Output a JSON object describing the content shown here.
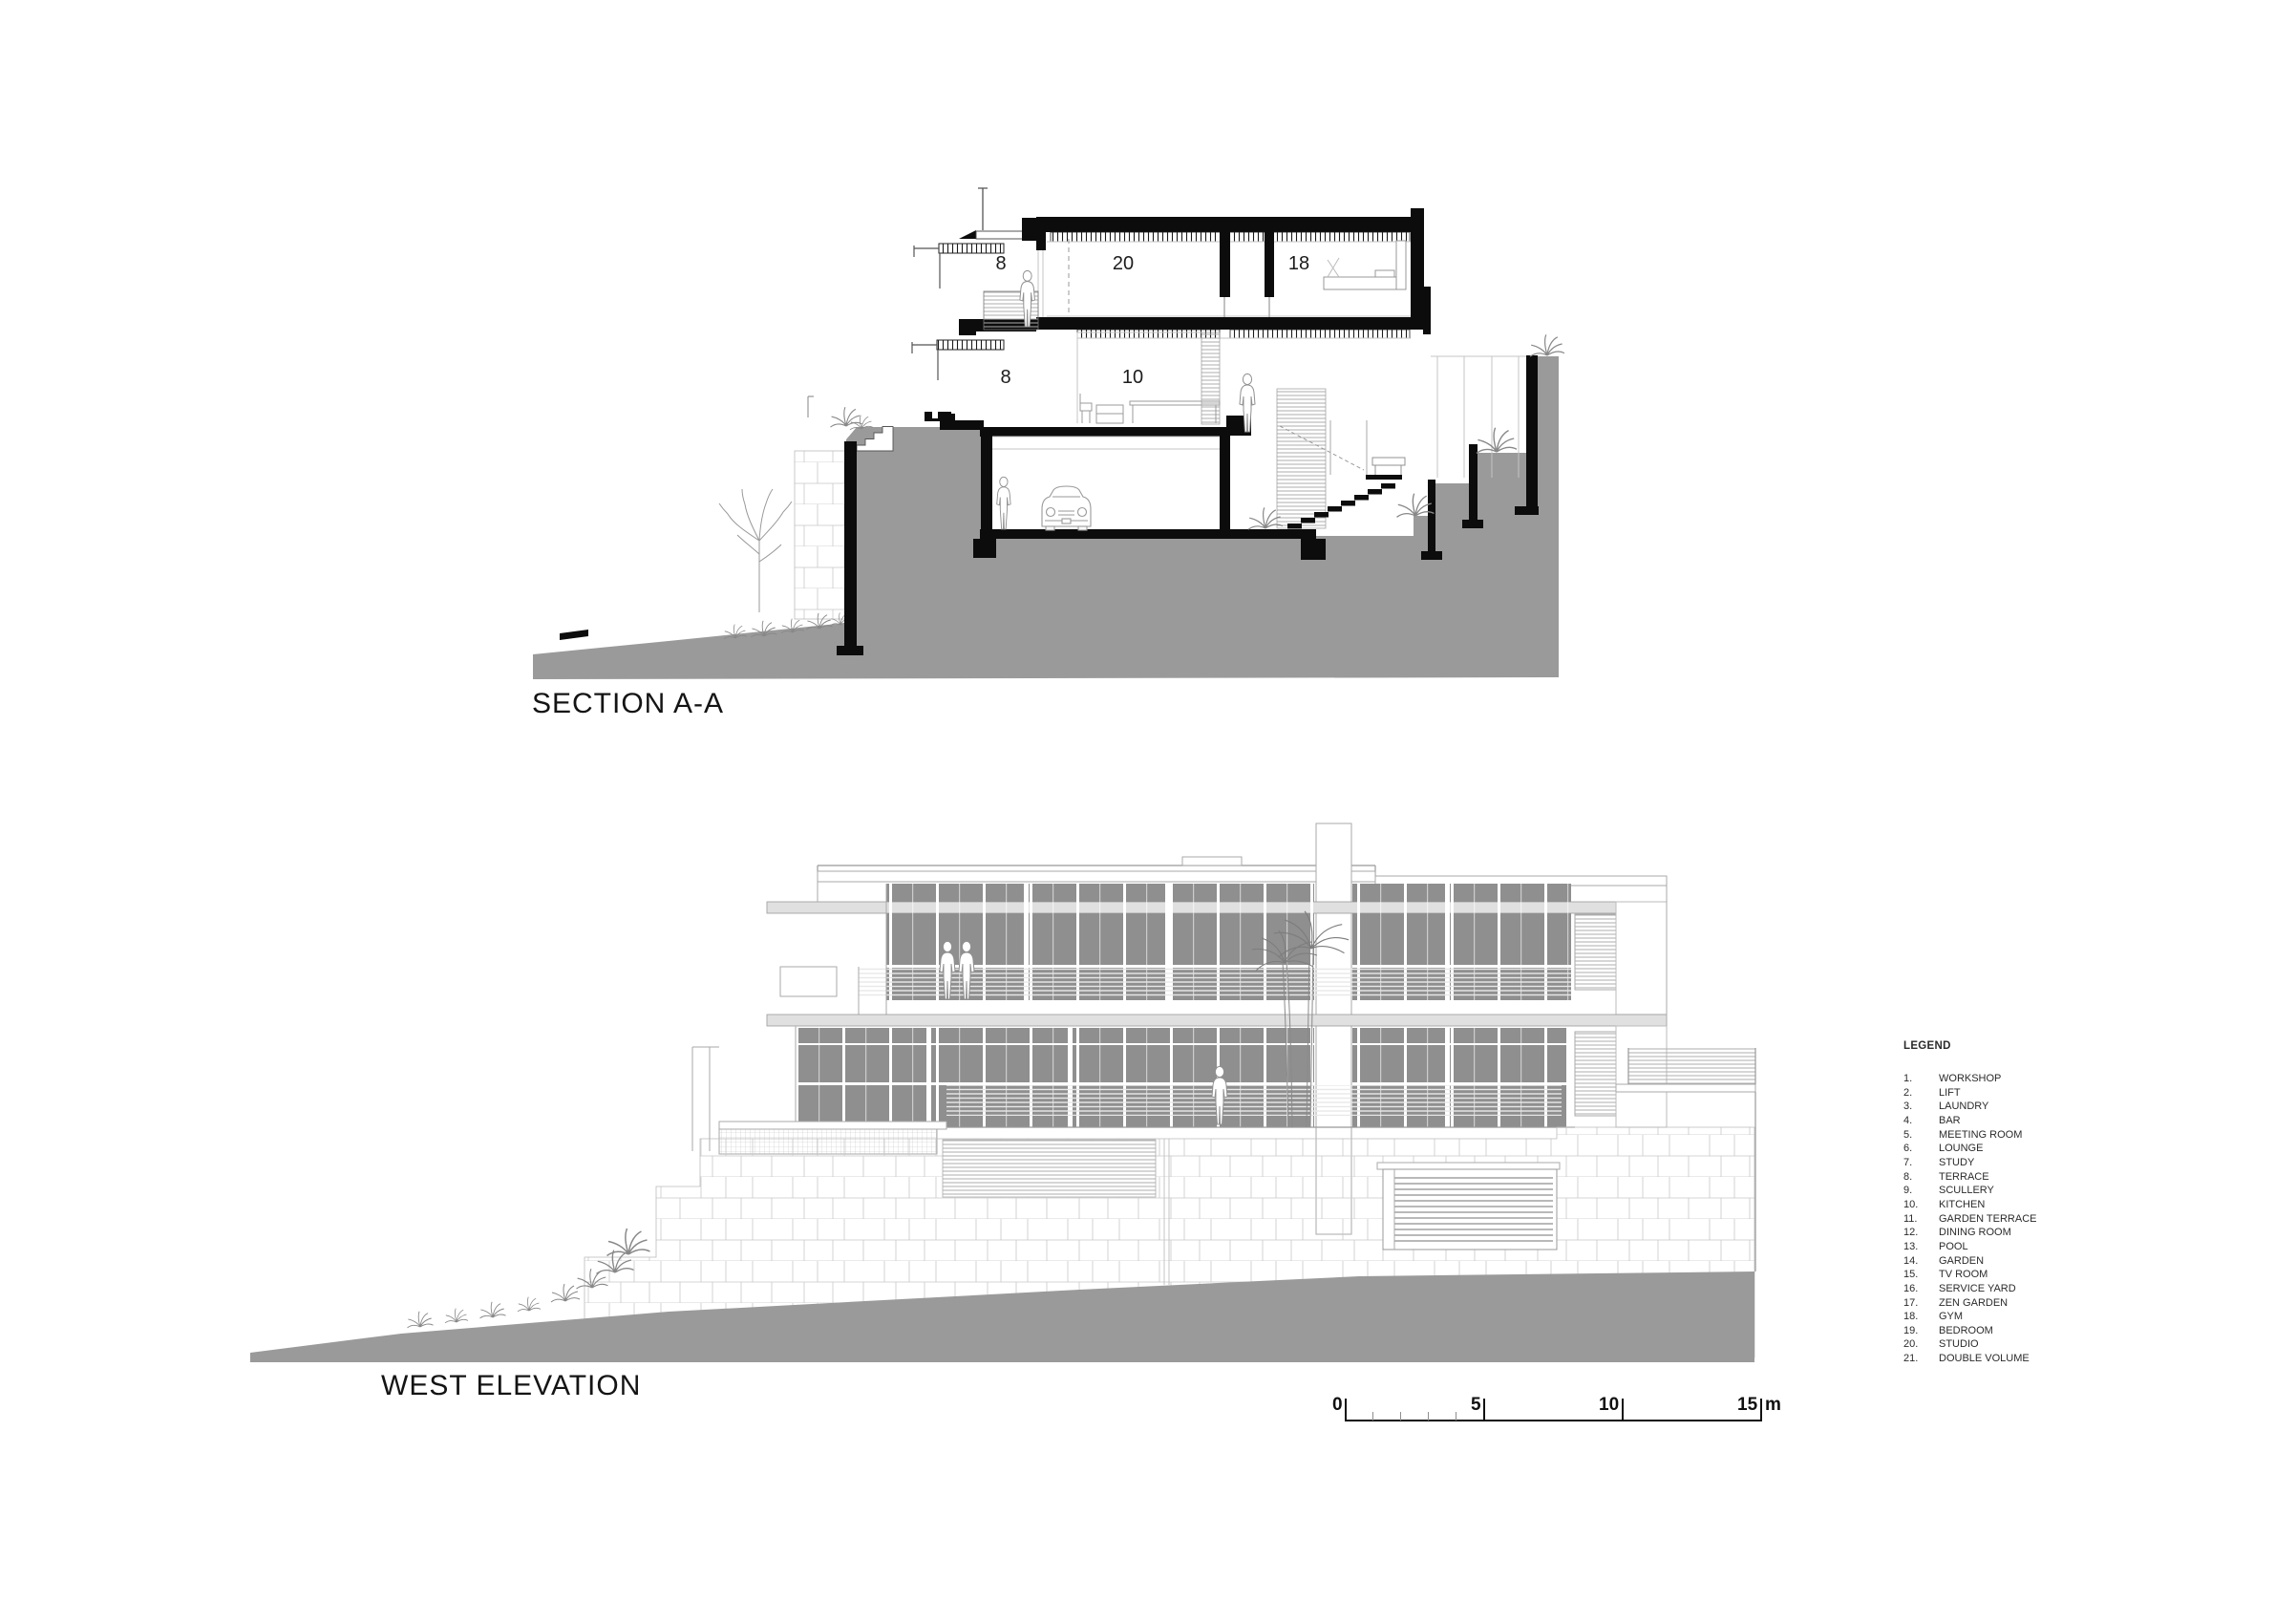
{
  "titles": {
    "section": "SECTION A-A",
    "elevation": "WEST ELEVATION"
  },
  "section": {
    "labels": [
      "8",
      "20",
      "18",
      "8",
      "10"
    ]
  },
  "legend": {
    "title": "LEGEND",
    "items": [
      {
        "num": "1.",
        "label": "WORKSHOP"
      },
      {
        "num": "2.",
        "label": "LIFT"
      },
      {
        "num": "3.",
        "label": "LAUNDRY"
      },
      {
        "num": "4.",
        "label": "BAR"
      },
      {
        "num": "5.",
        "label": "MEETING ROOM"
      },
      {
        "num": "6.",
        "label": "LOUNGE"
      },
      {
        "num": "7.",
        "label": "STUDY"
      },
      {
        "num": "8.",
        "label": "TERRACE"
      },
      {
        "num": "9.",
        "label": "SCULLERY"
      },
      {
        "num": "10.",
        "label": "KITCHEN"
      },
      {
        "num": "11.",
        "label": "GARDEN TERRACE"
      },
      {
        "num": "12.",
        "label": "DINING ROOM"
      },
      {
        "num": "13.",
        "label": "POOL"
      },
      {
        "num": "14.",
        "label": "GARDEN"
      },
      {
        "num": "15.",
        "label": "TV ROOM"
      },
      {
        "num": "16.",
        "label": "SERVICE YARD"
      },
      {
        "num": "17.",
        "label": "ZEN GARDEN"
      },
      {
        "num": "18.",
        "label": "GYM"
      },
      {
        "num": "19.",
        "label": "BEDROOM"
      },
      {
        "num": "20.",
        "label": "STUDIO"
      },
      {
        "num": "21.",
        "label": "DOUBLE VOLUME"
      }
    ]
  },
  "scale_bar": {
    "labels": [
      "0",
      "5",
      "10",
      "15"
    ],
    "unit": "m"
  },
  "colors": {
    "ground": "#9a9a9a",
    "glazing": "#8f8f8f",
    "slab": "#e0e0e0"
  }
}
